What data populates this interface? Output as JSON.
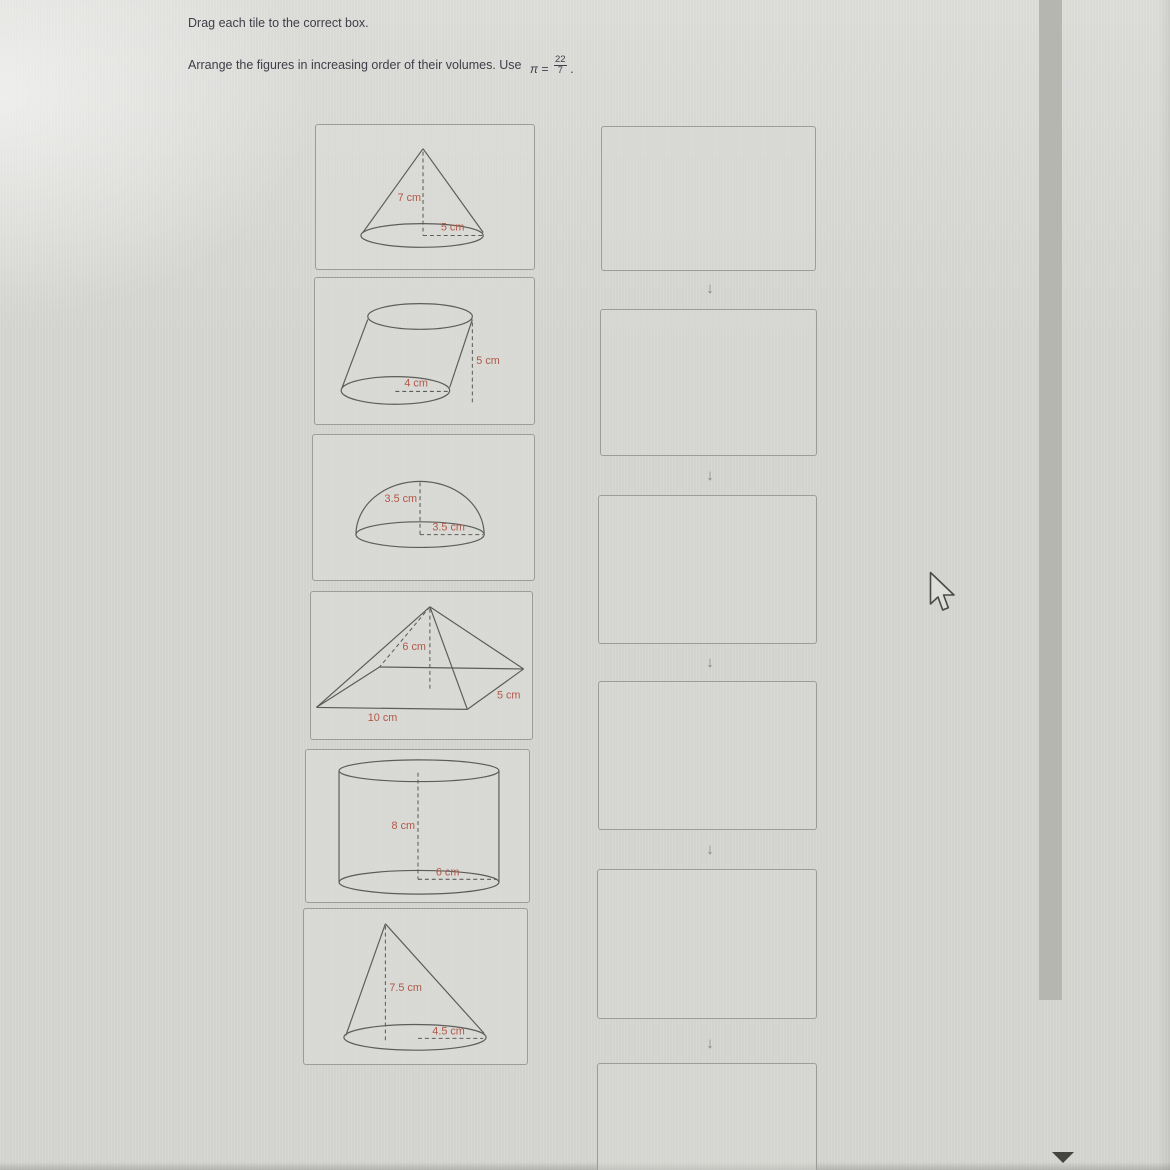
{
  "instructions": {
    "line1": "Drag each tile to the correct box.",
    "line2_prefix": "Arrange the figures in increasing order of their volumes. Use",
    "pi": "π",
    "equals": "=",
    "fraction_numerator": "22",
    "fraction_denominator": "7",
    "suffix": "."
  },
  "tiles": [
    {
      "shape": "cone",
      "labels": {
        "height": "7 cm",
        "radius": "5 cm"
      }
    },
    {
      "shape": "oblique-cylinder",
      "labels": {
        "height": "5 cm",
        "radius": "4 cm"
      }
    },
    {
      "shape": "hemisphere",
      "labels": {
        "height": "3.5 cm",
        "radius": "3.5 cm"
      }
    },
    {
      "shape": "rectangular-pyramid",
      "labels": {
        "height": "6 cm",
        "width": "5 cm",
        "length": "10 cm"
      }
    },
    {
      "shape": "cylinder",
      "labels": {
        "height": "8 cm",
        "radius": "6 cm"
      }
    },
    {
      "shape": "oblique-cone",
      "labels": {
        "height": "7.5 cm",
        "radius": "4.5 cm"
      }
    }
  ],
  "dropzone": {
    "box_count": 6,
    "arrow_glyph": "↓"
  },
  "scrollbar": {
    "down_glyph": "▼"
  },
  "colors": {
    "dimension_label": "#b25847",
    "figure_stroke": "#5c5c58",
    "box_border": "#9d9d97",
    "instruction_text": "#3e3e48",
    "page_background": "#d6d6d2",
    "scrollbar_thumb": "#b6b6b0"
  }
}
